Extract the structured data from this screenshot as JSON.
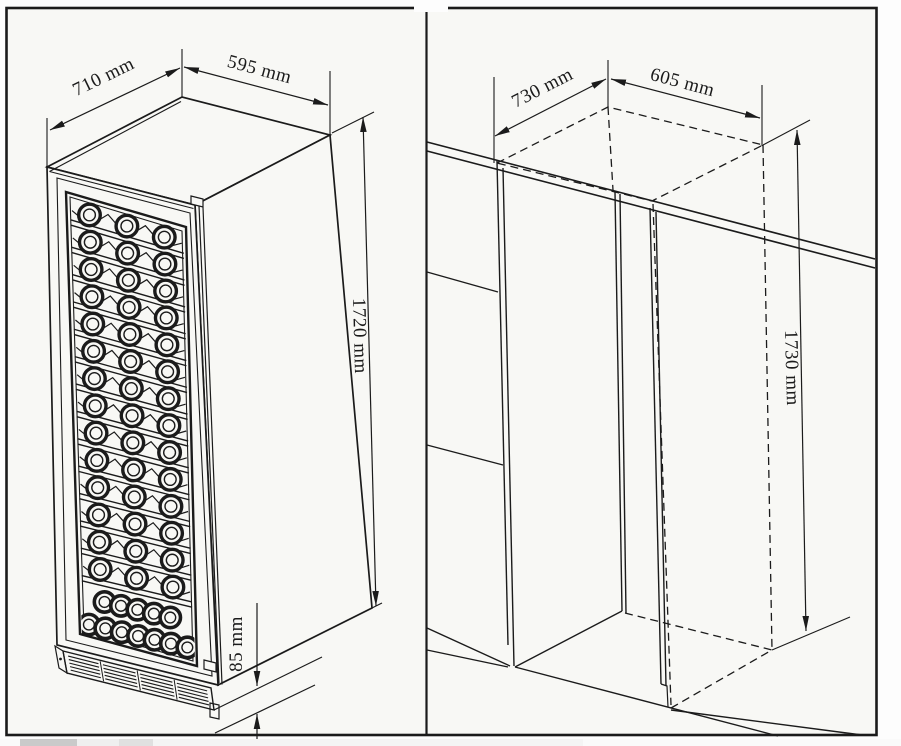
{
  "diagram": {
    "left_panel": {
      "unit": "wine-cooler",
      "dims": {
        "depth": "710 mm",
        "width": "595 mm",
        "height": "1720 mm",
        "plinth_height": "85 mm"
      },
      "rack": {
        "shelf_rows": 14,
        "bottles_per_shelf": 3,
        "bottom_stack": [
          5,
          7
        ]
      }
    },
    "right_panel": {
      "unit": "installation-niche",
      "dims": {
        "depth": "730 mm",
        "width": "605 mm",
        "height": "1730 mm"
      }
    },
    "colors": {
      "paper": "#f8f8f5",
      "ink": "#1b1b1b",
      "outside": "#fdfdfd",
      "scroll_thumb": "#cacaca",
      "scroll_track": "#f4f4f4"
    }
  }
}
